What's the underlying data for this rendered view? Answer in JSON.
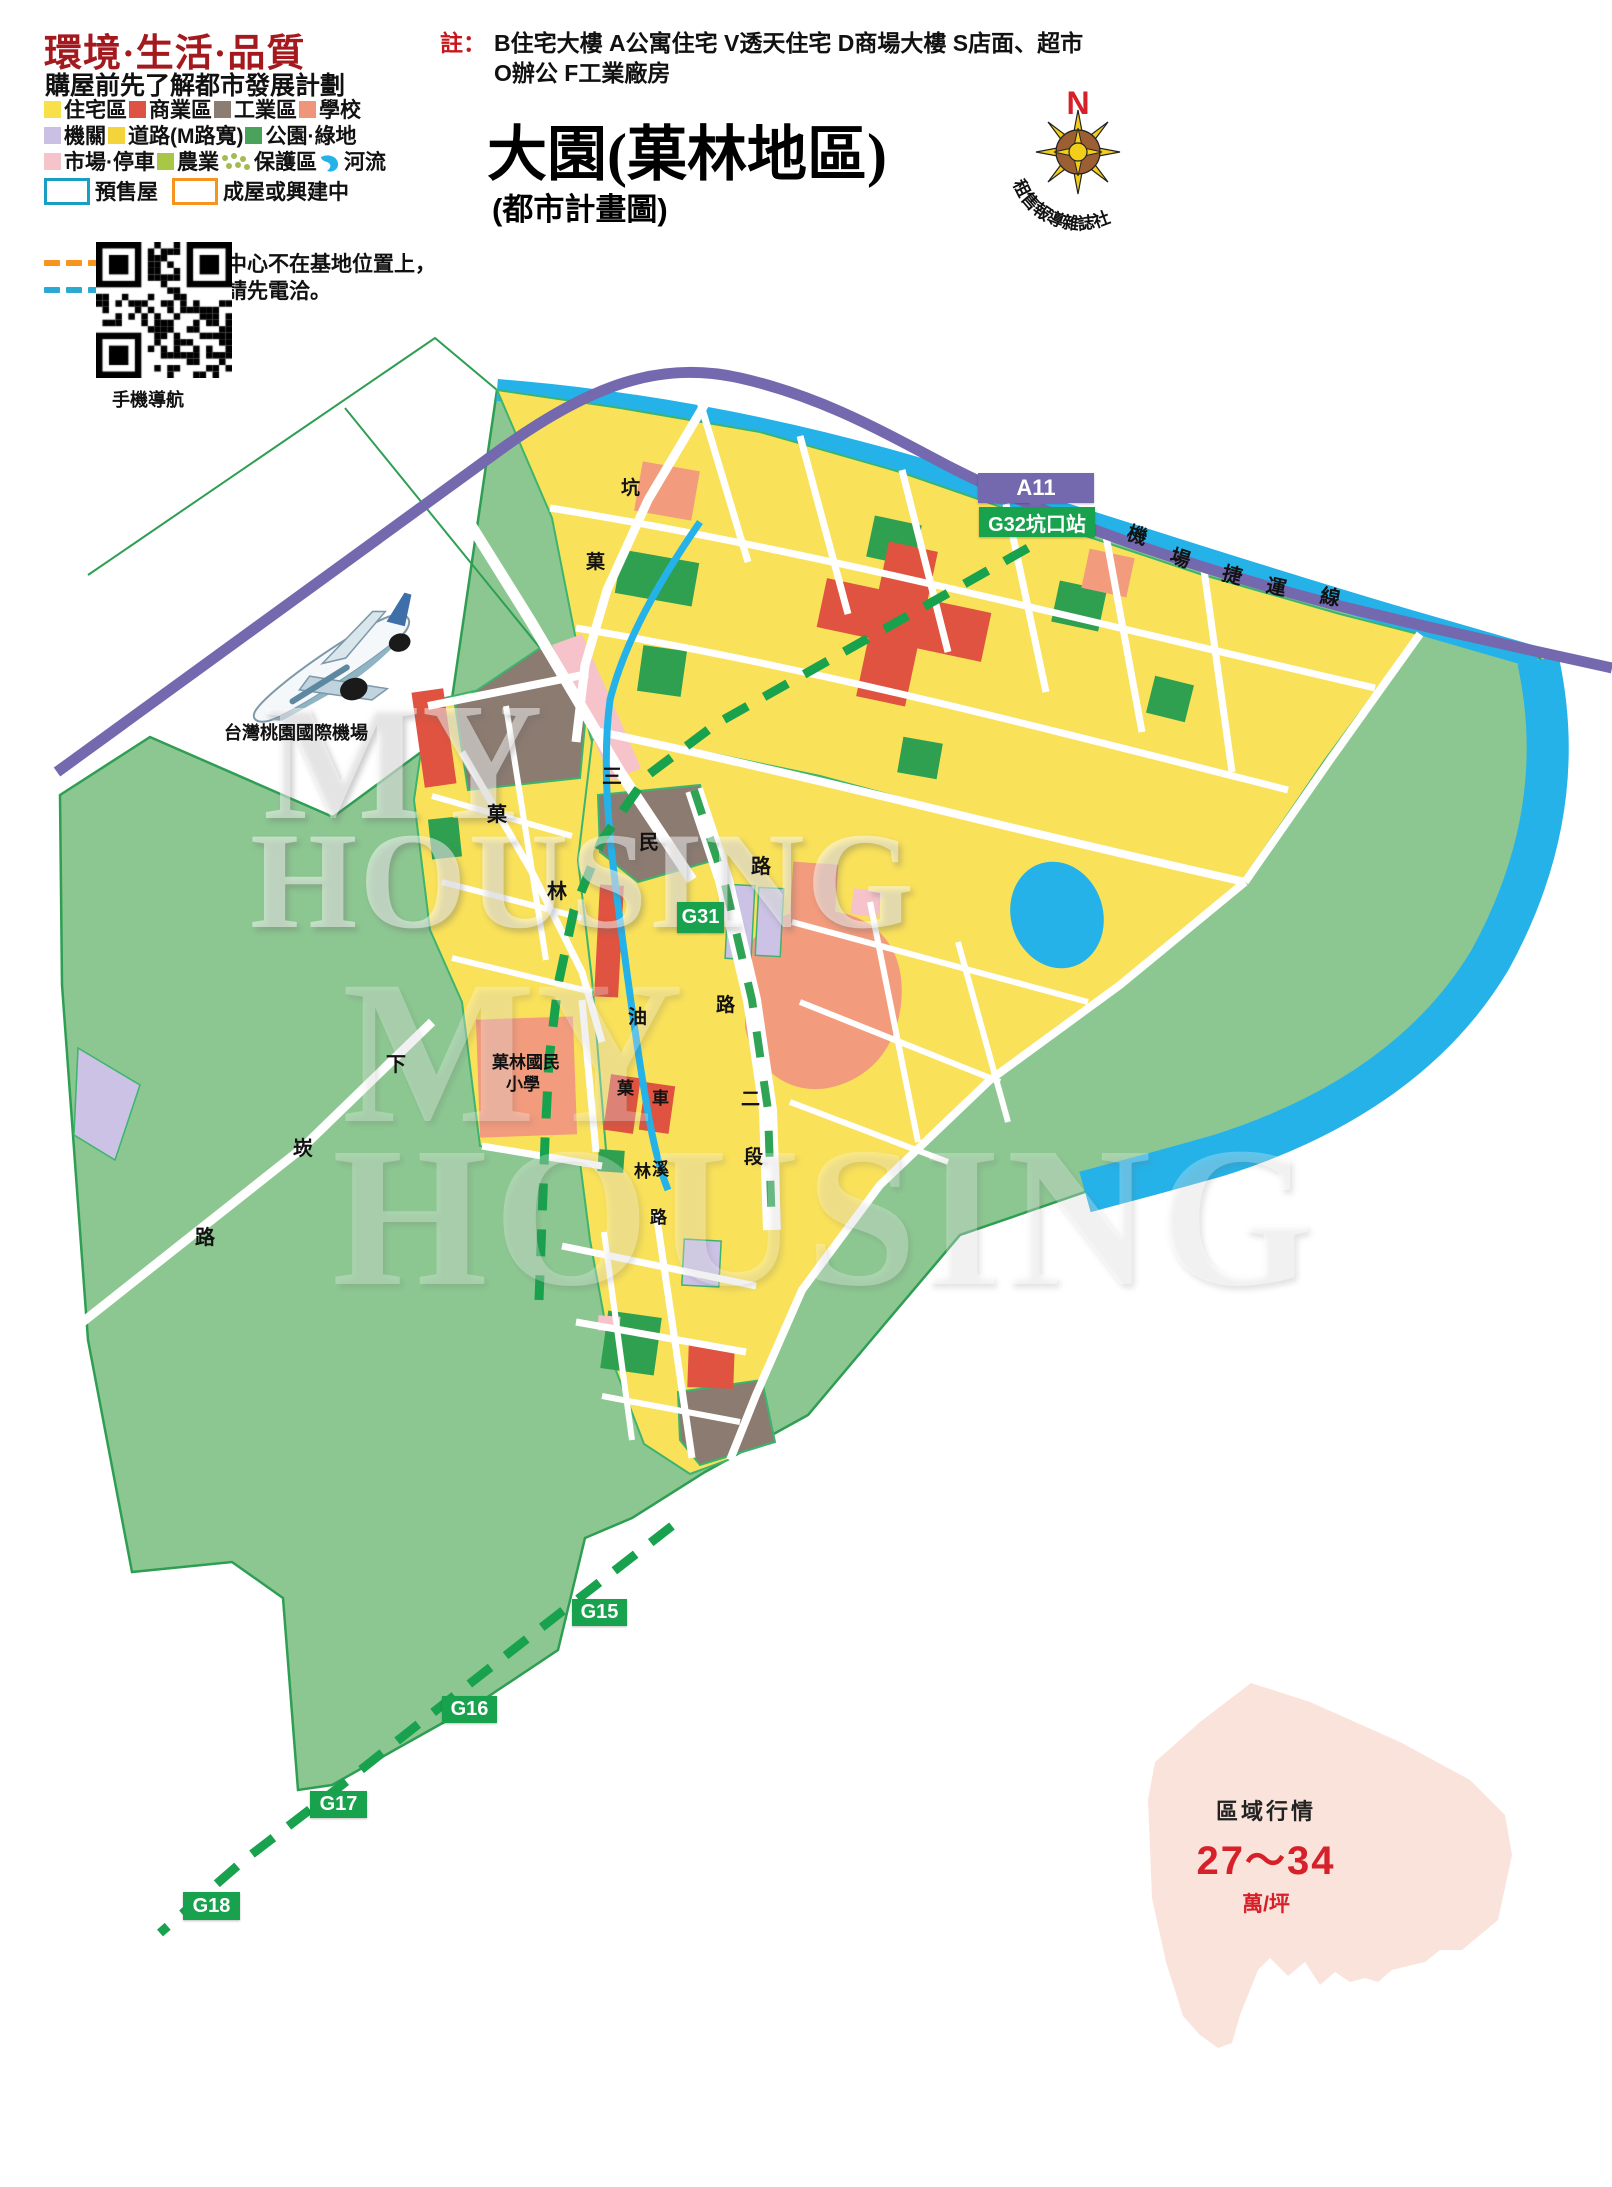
{
  "header": {
    "title": "環境·生活·品質",
    "subtitle": "購屋前先了解都市發展計劃"
  },
  "legend": {
    "rows": [
      {
        "items": [
          {
            "label": "住宅區",
            "swatch": "#F8E04B"
          },
          {
            "label": "商業區",
            "swatch": "#DD5244"
          },
          {
            "label": "工業區",
            "swatch": "#8B7D72"
          },
          {
            "label": "學校",
            "swatch": "#EF9579"
          }
        ]
      },
      {
        "items": [
          {
            "label": "機關",
            "swatch": "#C9C0E4"
          },
          {
            "label": "道路(M路寬)",
            "swatch": "#F3D43B"
          },
          {
            "label": "公園·綠地",
            "swatch": "#4BA25D"
          }
        ]
      },
      {
        "items": [
          {
            "label": "市場·停車",
            "swatch": "#F5C3CA"
          },
          {
            "label": "農業",
            "swatch": "#A8C845"
          },
          {
            "label": "保護區",
            "swatch": "dots"
          },
          {
            "label": "河流",
            "swatch": "river"
          }
        ]
      }
    ],
    "boxes": [
      {
        "label": "預售屋",
        "border": "#1A9FC4"
      },
      {
        "label": "成屋或興建中",
        "border": "#F7941D"
      }
    ],
    "notes": [
      {
        "dash_color": "#F7941D",
        "text": "代表接待中心不在基地位置上，"
      },
      {
        "dash_color": "#2BA9D2",
        "text": "如需前往請先電洽。"
      }
    ]
  },
  "annotation": {
    "prefix": "註：",
    "line1": "B住宅大樓 A公寓住宅 V透天住宅 D商場大樓 S店面、超市",
    "line2": "O辦公 F工業廠房"
  },
  "title_block": {
    "title": "大園(菓林地區)",
    "subtitle": "(都市計畫圖)"
  },
  "compass": {
    "n": "N",
    "org": "租售報導雜誌社"
  },
  "qr": {
    "caption": "手機導航"
  },
  "airport": {
    "label": "台灣桃園國際機場"
  },
  "watermark": {
    "line1": "MY",
    "line2": "HOUSING"
  },
  "price_panel": {
    "title": "區域行情",
    "range": "27～34",
    "unit": "萬/坪"
  },
  "map": {
    "colors": {
      "green_base": "#8CC791",
      "urban_yellow": "#F9E15A",
      "river_blue": "#25B2E8",
      "park_green": "#2FA04F",
      "commercial_red": "#DF5340",
      "school_salmon": "#F29B7D",
      "industry_brown": "#8C7B70",
      "institution_purple": "#CBC2E6",
      "market_pink": "#F6C3CB",
      "mrt_purple": "#7468AE",
      "station_green": "#18A24D",
      "price_pink": "#FAE3DB"
    },
    "badges": [
      {
        "text": "A11",
        "x": 978,
        "y": 473,
        "w": 116,
        "h": 30,
        "bg": "#7468AE",
        "fs": 22,
        "pointer": true
      },
      {
        "text": "G32坑口站",
        "x": 979,
        "y": 507,
        "w": 116,
        "h": 30,
        "bg": "#18A24D",
        "fs": 20,
        "pointer": false
      },
      {
        "text": "G31",
        "x": 677,
        "y": 902,
        "w": 47,
        "h": 31,
        "bg": "#18A24D",
        "fs": 20,
        "pointer": false
      },
      {
        "text": "G15",
        "x": 572,
        "y": 1599,
        "w": 55,
        "h": 27,
        "bg": "#18A24D",
        "fs": 20,
        "pointer": false
      },
      {
        "text": "G16",
        "x": 442,
        "y": 1696,
        "w": 55,
        "h": 27,
        "bg": "#18A24D",
        "fs": 20,
        "pointer": false
      },
      {
        "text": "G17",
        "x": 310,
        "y": 1791,
        "w": 57,
        "h": 27,
        "bg": "#18A24D",
        "fs": 20,
        "pointer": false
      },
      {
        "text": "G18",
        "x": 183,
        "y": 1892,
        "w": 57,
        "h": 28,
        "bg": "#18A24D",
        "fs": 20,
        "pointer": false
      }
    ],
    "labels": [
      {
        "t": "坑",
        "x": 621,
        "y": 479,
        "s": 19
      },
      {
        "t": "菓",
        "x": 586,
        "y": 553,
        "s": 19
      },
      {
        "t": "三",
        "x": 602,
        "y": 767,
        "s": 20
      },
      {
        "t": "民",
        "x": 639,
        "y": 833,
        "s": 20
      },
      {
        "t": "路",
        "x": 751,
        "y": 857,
        "s": 20
      },
      {
        "t": "菓",
        "x": 487,
        "y": 805,
        "s": 20
      },
      {
        "t": "林",
        "x": 547,
        "y": 882,
        "s": 20
      },
      {
        "t": "油",
        "x": 628,
        "y": 1008,
        "s": 19
      },
      {
        "t": "路",
        "x": 716,
        "y": 996,
        "s": 19
      },
      {
        "t": "菓",
        "x": 617,
        "y": 1080,
        "s": 17
      },
      {
        "t": "車",
        "x": 652,
        "y": 1090,
        "s": 17
      },
      {
        "t": "二",
        "x": 741,
        "y": 1090,
        "s": 19
      },
      {
        "t": "段",
        "x": 744,
        "y": 1148,
        "s": 19
      },
      {
        "t": "林",
        "x": 634,
        "y": 1163,
        "s": 17
      },
      {
        "t": "溪",
        "x": 652,
        "y": 1161,
        "s": 17
      },
      {
        "t": "路",
        "x": 650,
        "y": 1209,
        "s": 17
      },
      {
        "t": "下",
        "x": 386,
        "y": 1055,
        "s": 20
      },
      {
        "t": "崁",
        "x": 293,
        "y": 1139,
        "s": 20
      },
      {
        "t": "路",
        "x": 195,
        "y": 1228,
        "s": 20
      },
      {
        "t": "機",
        "x": 1127,
        "y": 526,
        "s": 20,
        "r": 18
      },
      {
        "t": "場",
        "x": 1170,
        "y": 549,
        "s": 20,
        "r": 18
      },
      {
        "t": "捷",
        "x": 1222,
        "y": 566,
        "s": 20,
        "r": 14
      },
      {
        "t": "運",
        "x": 1266,
        "y": 578,
        "s": 20,
        "r": 12
      },
      {
        "t": "線",
        "x": 1320,
        "y": 588,
        "s": 20,
        "r": 10
      },
      {
        "t": "菓林國民",
        "x": 492,
        "y": 1054,
        "s": 17
      },
      {
        "t": "小學",
        "x": 506,
        "y": 1076,
        "s": 17
      },
      {
        "t": "台灣桃園國際機場",
        "x": 224,
        "y": 724,
        "s": 18
      }
    ]
  }
}
